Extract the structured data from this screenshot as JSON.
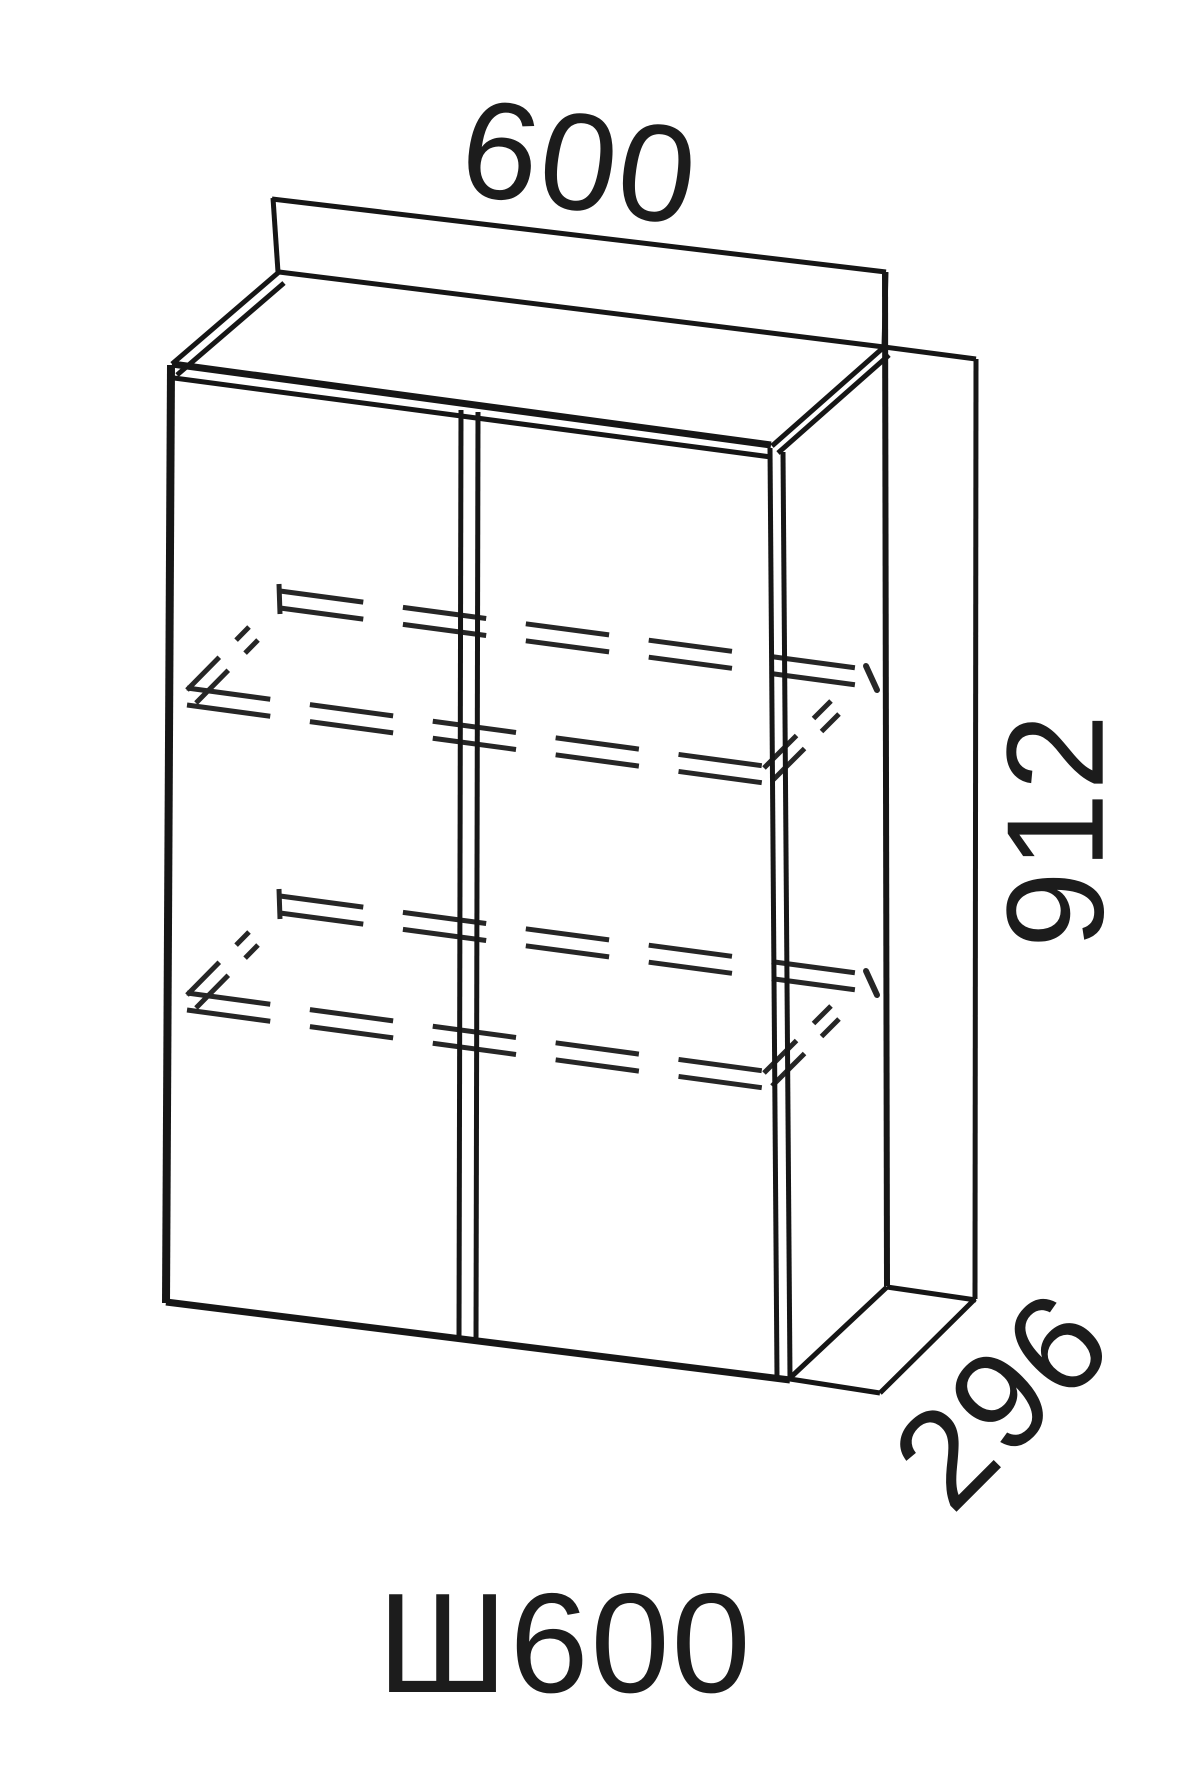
{
  "drawing": {
    "product_code": "Ш600",
    "dimensions": {
      "width": "600",
      "height": "912",
      "depth": "296"
    },
    "colors": {
      "background": "#ffffff",
      "line": "#161616",
      "hidden_line": "#262626",
      "text": "#1c1c1c"
    }
  }
}
